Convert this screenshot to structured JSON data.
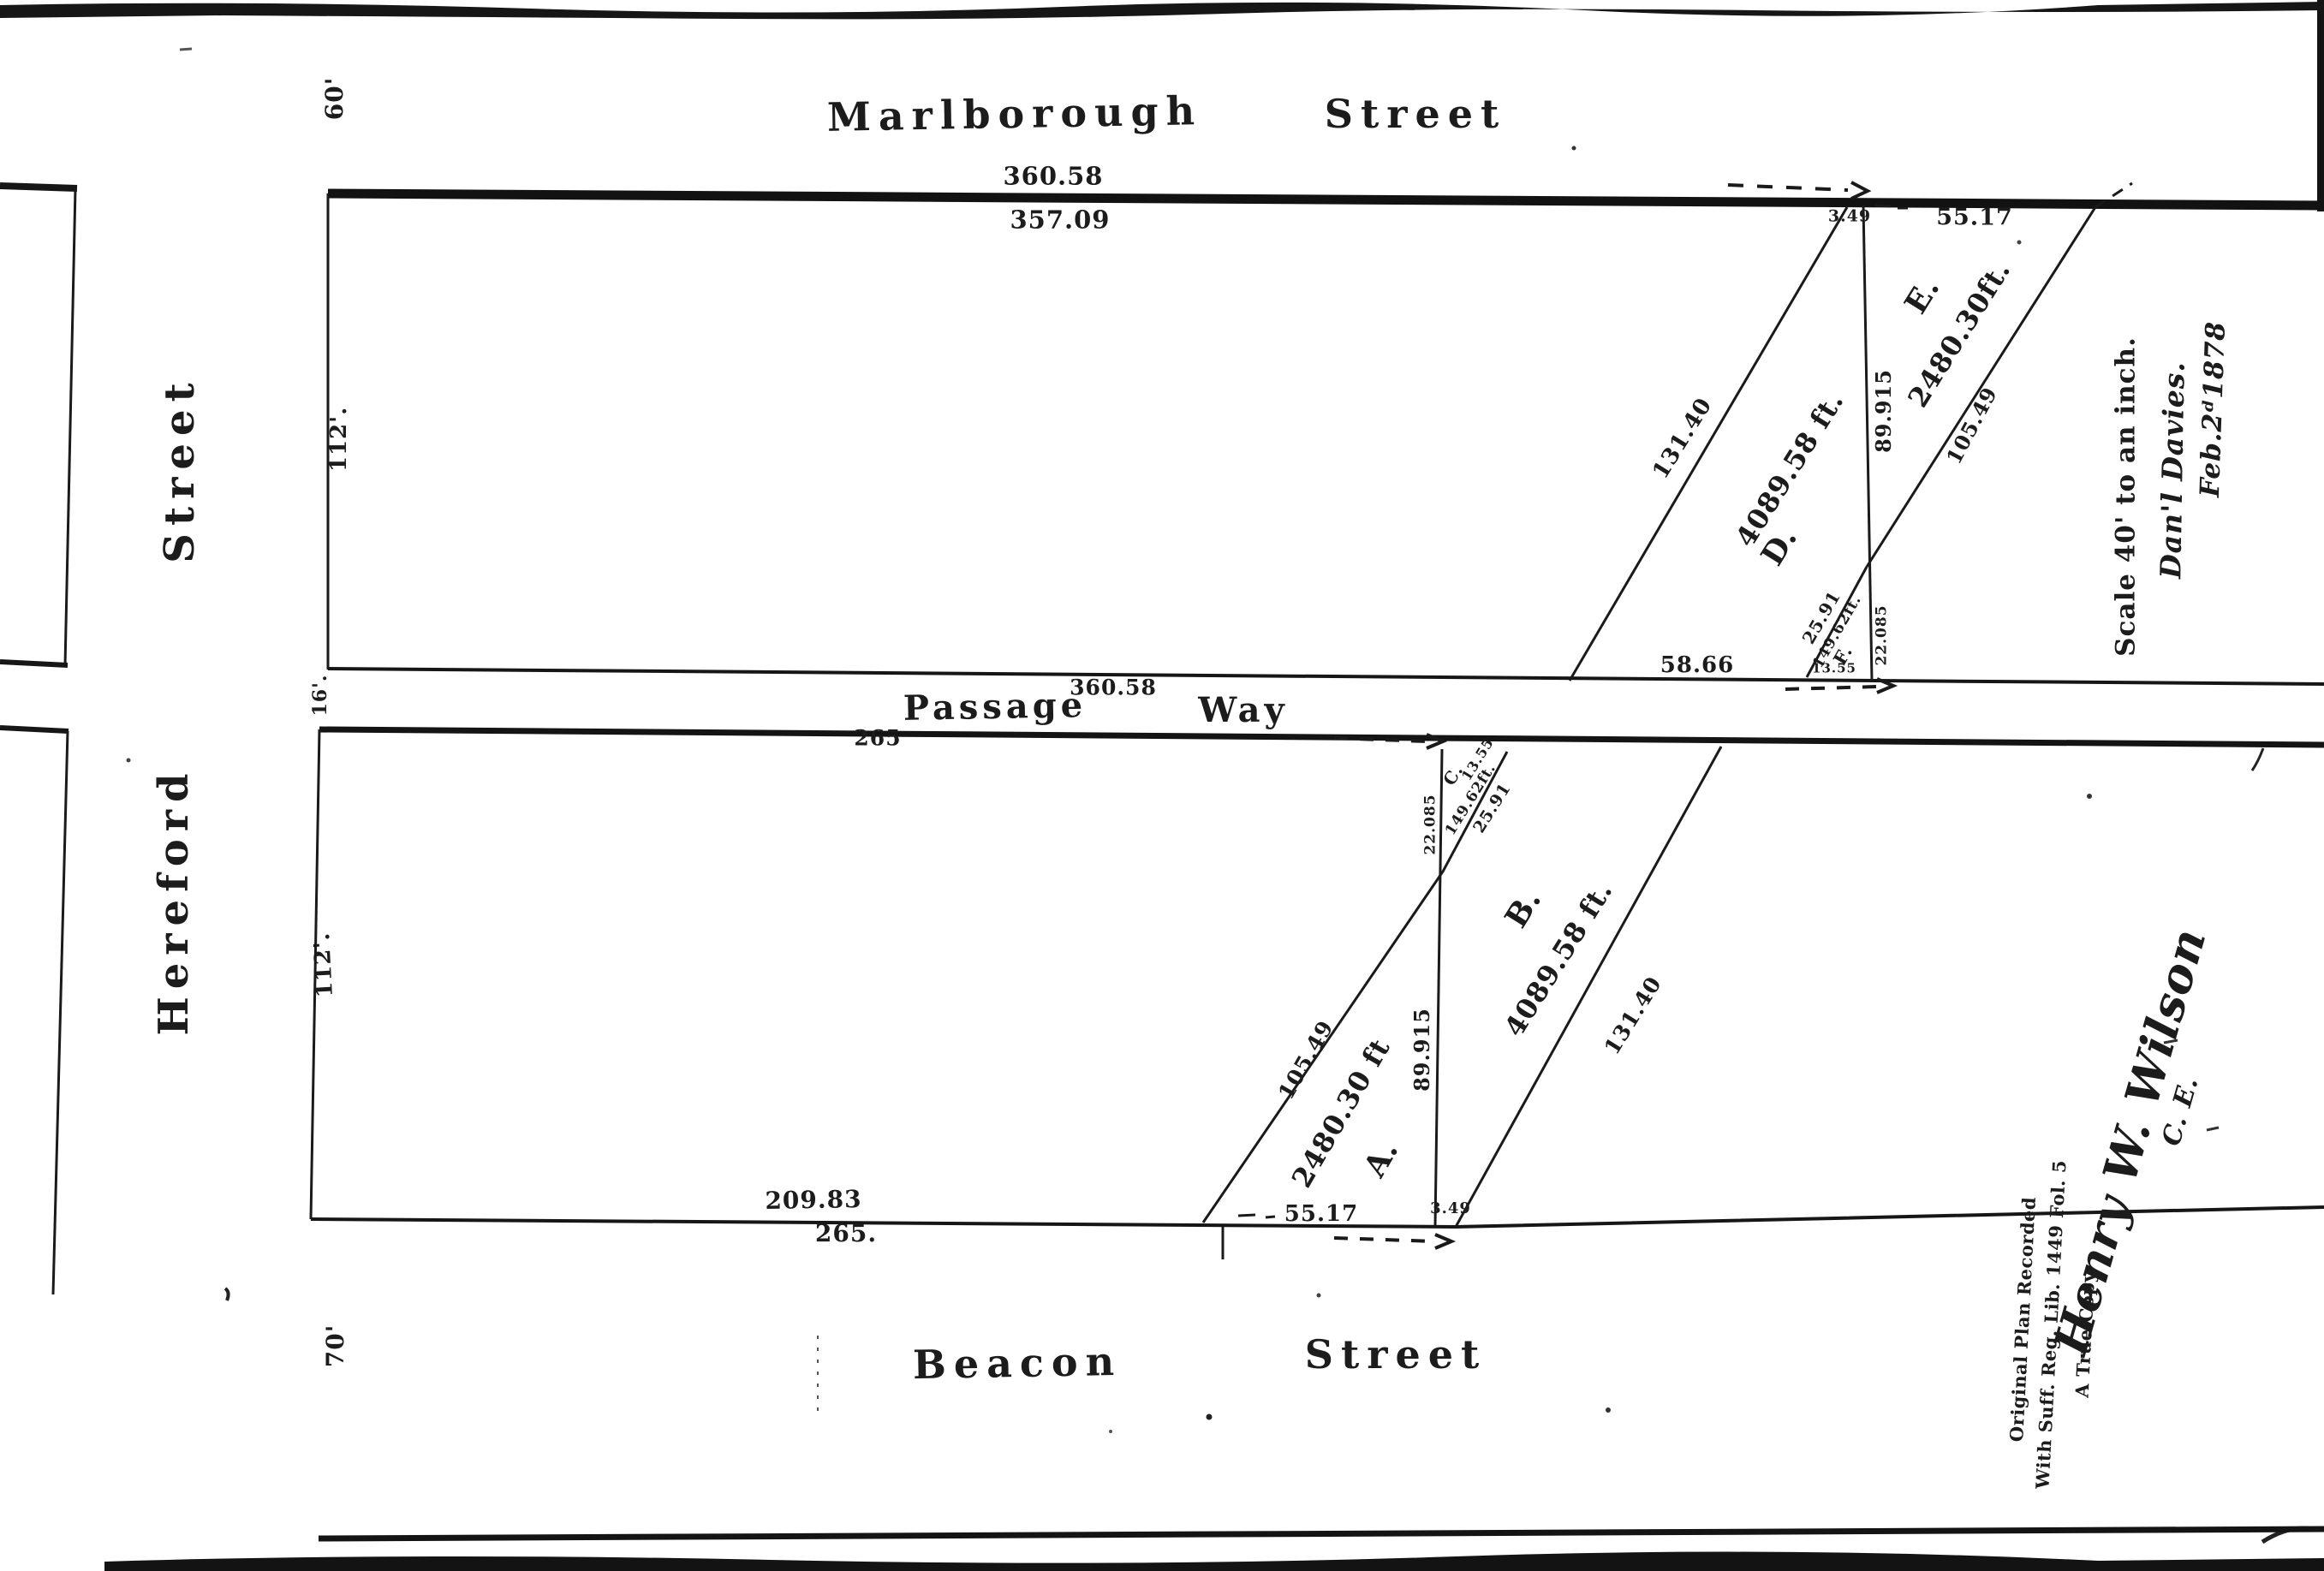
{
  "plan": {
    "streets": {
      "marlborough": {
        "name": "Marlborough",
        "word_street": "Street",
        "width": "60'",
        "dim_north": "360.58",
        "dim_south": "357.09"
      },
      "hereford": {
        "name": "Hereford",
        "word_street": "Street"
      },
      "passage": {
        "name": "Passage",
        "word_way": "Way",
        "width": "16'.",
        "dim_north": "360.58",
        "dim_south": "265"
      },
      "beacon": {
        "name": "Beacon",
        "word_street": "Street",
        "width": "70'",
        "dim_frontage": "209.83",
        "dim_total": "265."
      }
    },
    "blocks": {
      "upper": {
        "depth": "112'."
      },
      "lower": {
        "depth": "112'."
      }
    },
    "parcels": {
      "A": {
        "label": "A.",
        "area": "2480.30 ft",
        "hyp": "105.49",
        "side": "89.915",
        "base": "55.17"
      },
      "B": {
        "label": "B.",
        "area": "4089.58 ft.",
        "diag": "131.40",
        "gap": "3.49"
      },
      "C": {
        "label": "C.",
        "area": "149.62ft.",
        "hyp": "25.91",
        "base": "13.55",
        "side": "22.085"
      },
      "D": {
        "label": "D.",
        "area": "4089.58 ft.",
        "diag": "131.40",
        "south": "58.66",
        "gap": "3.49"
      },
      "E": {
        "label": "E.",
        "area": "2480.30ft.",
        "hyp": "105.49",
        "side": "89.915",
        "base": "55.17"
      },
      "F": {
        "label": "F.",
        "area": "149.62ft.",
        "hyp": "25.91",
        "base": "13.55",
        "side": "22.085"
      }
    },
    "notes": {
      "scale": "Scale 40' to an inch.",
      "surveyor": "Dan'l Davies.",
      "date": "Feb.2ᵈ1878",
      "recording_line1": "Original Plan Recorded",
      "recording_line2": "With Suff. Reg. Lib. 1449 Fol. 5",
      "recording_line3": "A True Copy.",
      "signature": "Henry W. Wilson",
      "signature_title": "C. E."
    }
  }
}
